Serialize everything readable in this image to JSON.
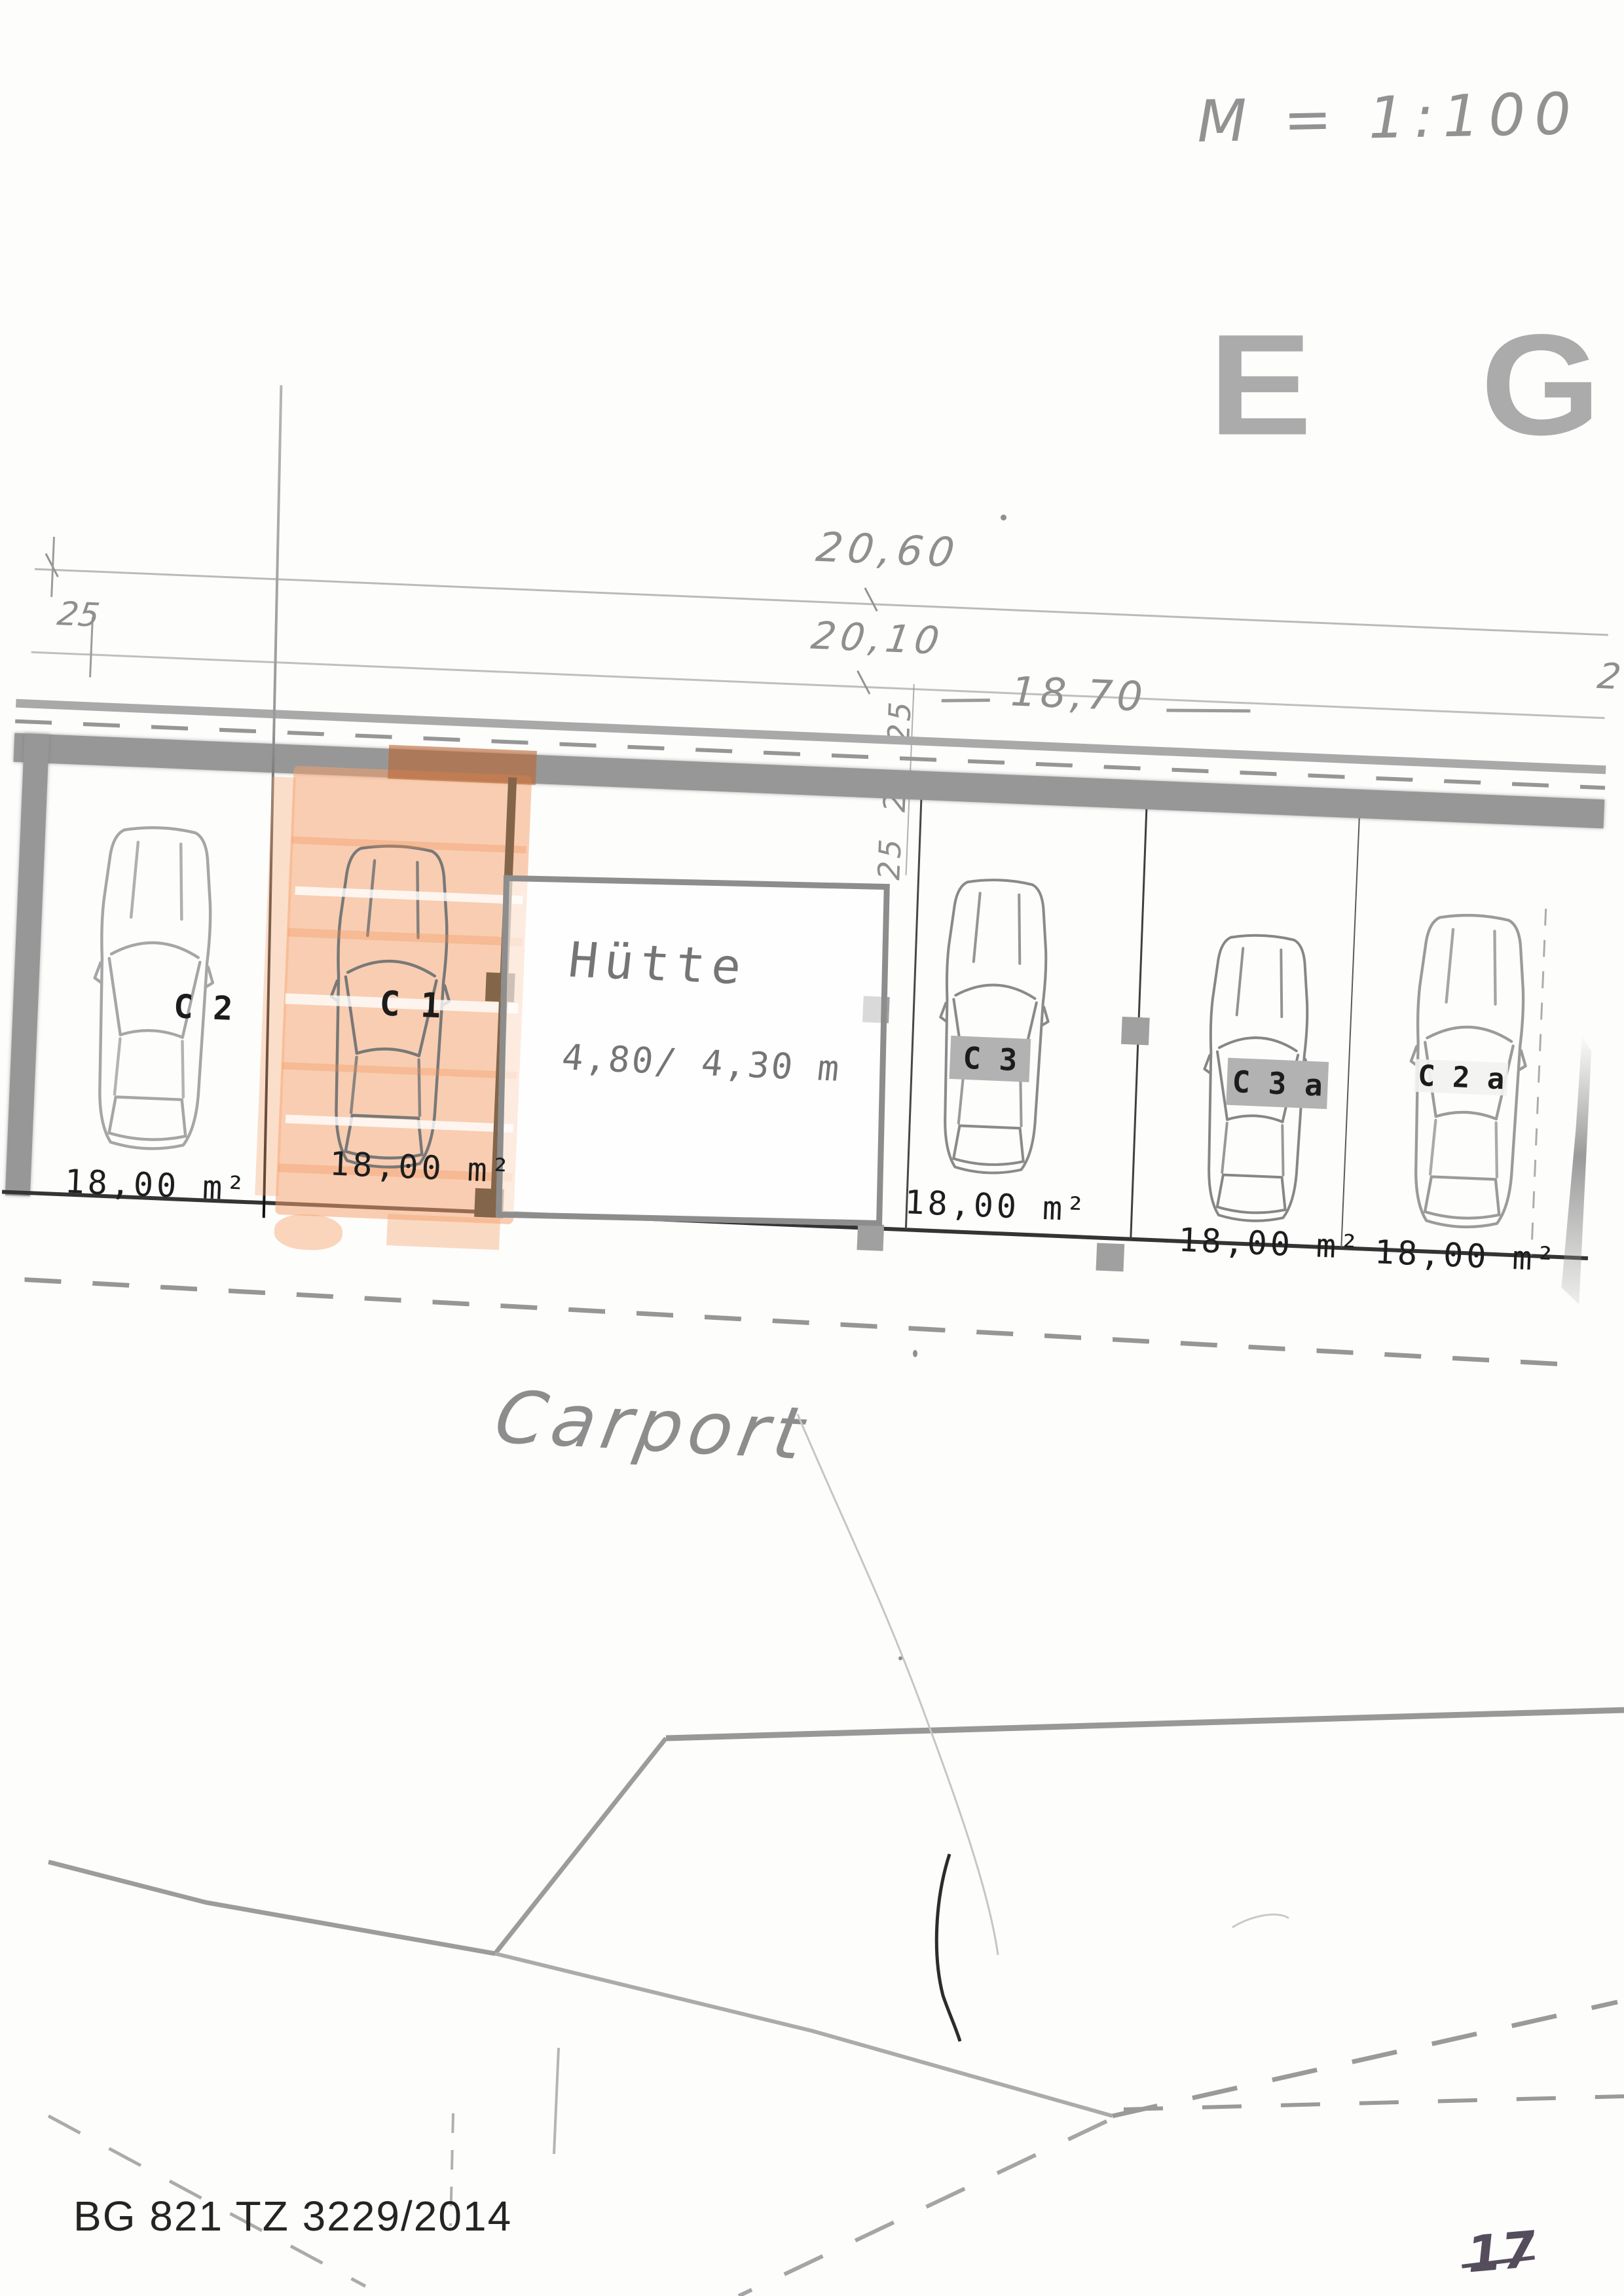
{
  "header": {
    "scale_note": "M = 1:100",
    "floor_label": "E G"
  },
  "dimensions": {
    "overall_width": "20,60",
    "inner_width_upper": "20,10",
    "carport_width": "18,70",
    "left_offset": "25",
    "vertical_offsets": [
      "25",
      "25",
      "25"
    ],
    "right_edge_partial": "2"
  },
  "carport": {
    "title": "Carport",
    "stalls": [
      {
        "code": "C 2",
        "area": "18,00 m²",
        "highlighted": false,
        "label_style": "plain"
      },
      {
        "code": "C 1",
        "area": "18,00 m²",
        "highlighted": true,
        "label_style": "plain"
      },
      {
        "code": "C 3",
        "area": "18,00 m²",
        "highlighted": false,
        "label_style": "gray-box"
      },
      {
        "code": "C 3 a",
        "area": "18,00 m²",
        "highlighted": false,
        "label_style": "gray-box"
      },
      {
        "code": "C 2 a",
        "area": "18,00 m²",
        "highlighted": false,
        "label_style": "light-band"
      }
    ],
    "hut": {
      "name": "Hütte",
      "size": "4,80/ 4,30 m"
    }
  },
  "footer": {
    "document_ref": "BG 821 TZ 3229/2014",
    "page_number": "17"
  },
  "colors": {
    "highlight_orange": "#f4a06e",
    "wall_gray": "#969696",
    "pencil_gray": "#8f8f8f",
    "post_brown": "#83654a",
    "ink_black": "#1f1f1f"
  }
}
